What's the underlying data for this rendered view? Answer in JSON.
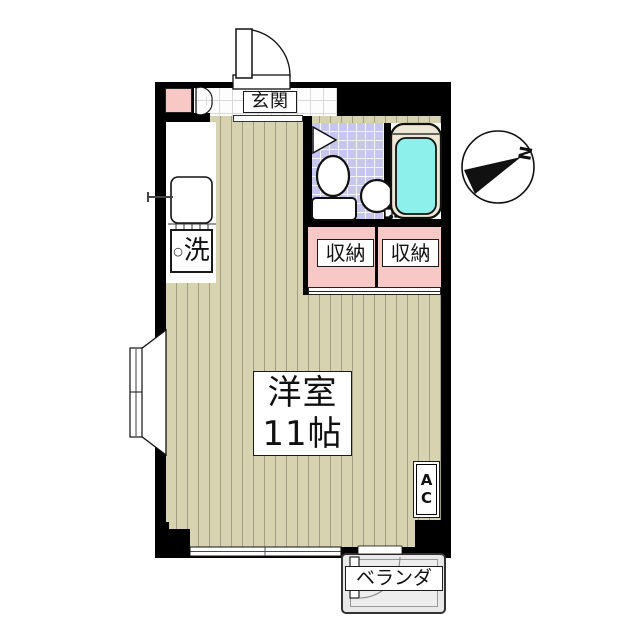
{
  "plan": {
    "entrance": {
      "label": "玄関"
    },
    "kitchen": {
      "washer_prefix": "○",
      "washer_label": "洗"
    },
    "storages": [
      {
        "label": "収納"
      },
      {
        "label": "収納"
      }
    ],
    "room": {
      "name": "洋室",
      "size": "11帖"
    },
    "ac": {
      "line1": "A",
      "line2": "C"
    },
    "veranda": {
      "label": "ベランダ"
    },
    "compass": {
      "north": "N"
    }
  },
  "icons": {
    "compass": "compass-north-arrow",
    "toilet": "toilet-top-view",
    "bathtub": "bathtub-top-view",
    "washbasin": "round-basin",
    "kitchen_sink": "kitchen-sink",
    "entrance_door": "swing-door-arc",
    "bay_window": "bay-window",
    "veranda_door": "swing-door-arc"
  },
  "colors": {
    "wall": "#000000",
    "wood_floor": "#d7d3b1",
    "wood_stripe": "#a29d82",
    "closet_pink": "#f8c8c6",
    "bath_tile": "#c6c6ef",
    "bath_water": "#8df0ea",
    "tub_rim": "#ece8d5",
    "veranda_fill": "#e9e9e9"
  }
}
